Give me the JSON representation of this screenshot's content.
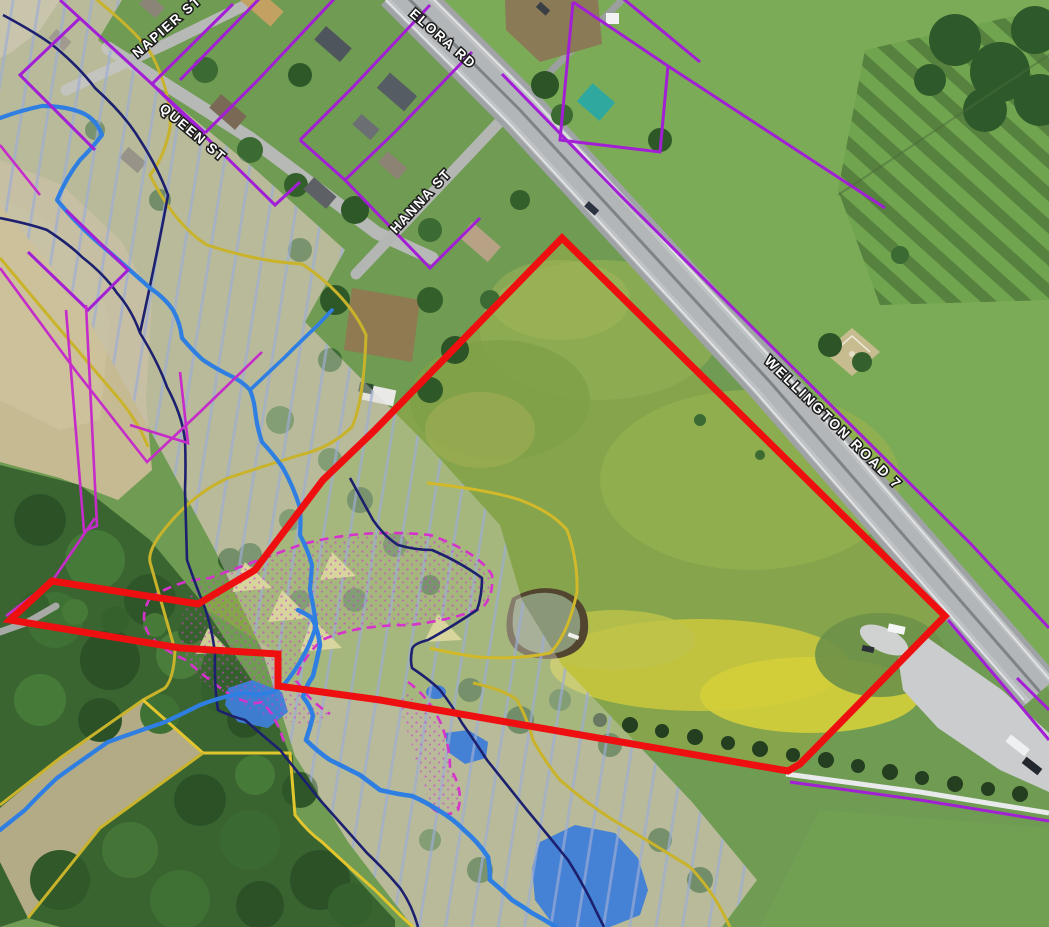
{
  "map": {
    "description": "Aerial GIS map view of a village edge with a highlighted subject parcel along Wellington Road 7",
    "street_labels": [
      {
        "id": "napier-st",
        "text": "NAPIER ST"
      },
      {
        "id": "queen-st",
        "text": "QUEEN ST"
      },
      {
        "id": "elora-rd",
        "text": "ELORA RD"
      },
      {
        "id": "hanna-st",
        "text": "HANNA ST"
      },
      {
        "id": "wellington-road-7",
        "text": "WELLINGTON ROAD 7"
      }
    ],
    "overlays": {
      "subject_parcel_outline": "#ee1010",
      "parcel_fabric_lines": "#a21fd6",
      "wetland_dashed_boundary": "#d633cc",
      "flood_contour_line": "#1c206e",
      "watercourse_line": "#2f7fe2",
      "greenlands_boundary": "#c9b32b",
      "flood_hatch": "#9dadd6",
      "water_pool_fill": "#3e7ed8"
    }
  }
}
